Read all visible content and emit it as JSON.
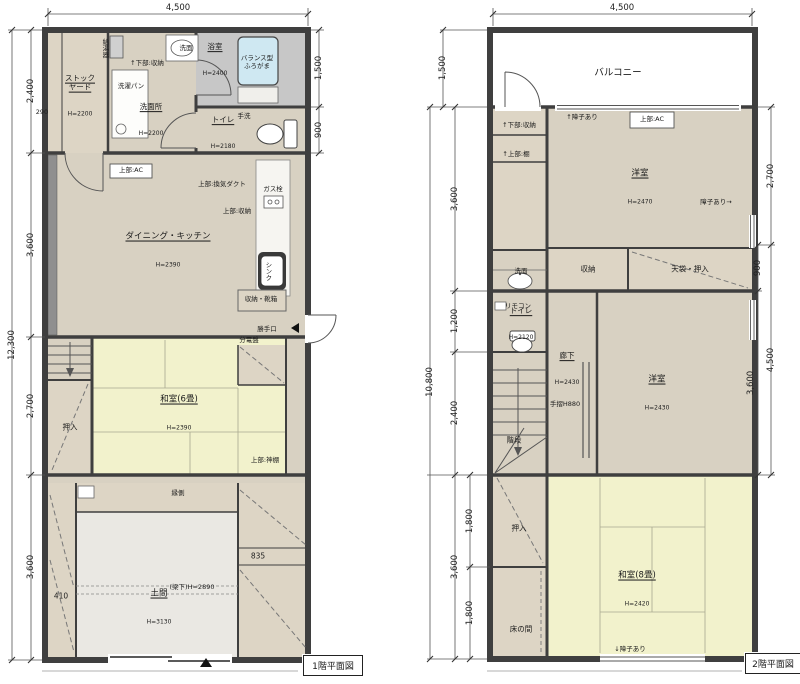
{
  "floor1": {
    "title": "1階平面図",
    "dims": {
      "top": "4,500",
      "left_total": "12,300",
      "ls0": "2,400",
      "ls1": "3,600",
      "ls2": "2,700",
      "ls3": "3,600",
      "rs0": "1,500",
      "rs1": "900",
      "w290": "290",
      "w410": "410",
      "w835": "835",
      "beam": "(梁下)H=2890"
    },
    "rooms": {
      "stockyard": {
        "name": "ストック\nヤード",
        "h": "H=2200"
      },
      "senmenjo": {
        "name": "洗面所",
        "h": "H=2200"
      },
      "bath": {
        "name": "浴室",
        "h": "H=2400"
      },
      "toilet": {
        "name": "トイレ",
        "h": "H=2180"
      },
      "dk": {
        "name": "ダイニング・キッチン",
        "h": "H=2390"
      },
      "washitsu6": {
        "name": "和室(6畳)",
        "h": "H=2390"
      },
      "doma": {
        "name": "土間",
        "h": "H=3130"
      },
      "oshiire": {
        "name": "押入"
      },
      "engawa": {
        "name": "縁側"
      }
    },
    "notes": {
      "kyutoki": "給湯器",
      "senmen": "洗面",
      "shita_shunou": "↑下部:収納",
      "sentakupan": "洗濯パン",
      "furogama": "バランス型\nふろがま",
      "tearai": "手洗",
      "ac": "上部:AC",
      "kanki": "上部:換気ダクト",
      "gas": "ガス栓",
      "ue_shunou": "上部:収納",
      "sink": "シンク",
      "kutsubako": "収納・靴箱",
      "katteguchi": "勝手口",
      "bundenban": "分電盤",
      "kamidana": "上部:神棚"
    }
  },
  "floor2": {
    "title": "2階平面図",
    "dims": {
      "top": "4,500",
      "balcony": "1,500",
      "left_total": "10,800",
      "ls0": "3,600",
      "ls1": "1,200",
      "ls2": "2,400",
      "ls3": "3,600",
      "in0": "1,800",
      "in1": "1,800",
      "r0": "2,700",
      "r1": "900",
      "r2": "3,600",
      "r3": "4,500"
    },
    "rooms": {
      "balcony": {
        "name": "バルコニー"
      },
      "youshitsu_u": {
        "name": "洋室",
        "h": "H=2470"
      },
      "youshitsu_l": {
        "name": "洋室",
        "h": "H=2430"
      },
      "washitsu8": {
        "name": "和室(8畳)",
        "h": "H=2420"
      },
      "rouka": {
        "name": "廊下",
        "h": "H=2430"
      },
      "toilet": {
        "name": "トイレ",
        "h": "H=2120"
      },
      "shunou": {
        "name": "収納"
      },
      "tenbukuro": {
        "name": "天袋・押入"
      },
      "kaidan": {
        "name": "階段"
      },
      "oshiire": {
        "name": "押入"
      },
      "tokonoma": {
        "name": "床の間"
      }
    },
    "notes": {
      "shoji_top": "↑障子あり",
      "ac": "上部:AC",
      "shoji_right": "障子あり→",
      "shita_shunou": "↑下部:収納",
      "ue_tana": "↑上部:棚",
      "senmen": "洗面",
      "remocon": "リモコン",
      "tesuri": "手摺H880",
      "shoji_bottom": "↓障子あり"
    }
  }
}
